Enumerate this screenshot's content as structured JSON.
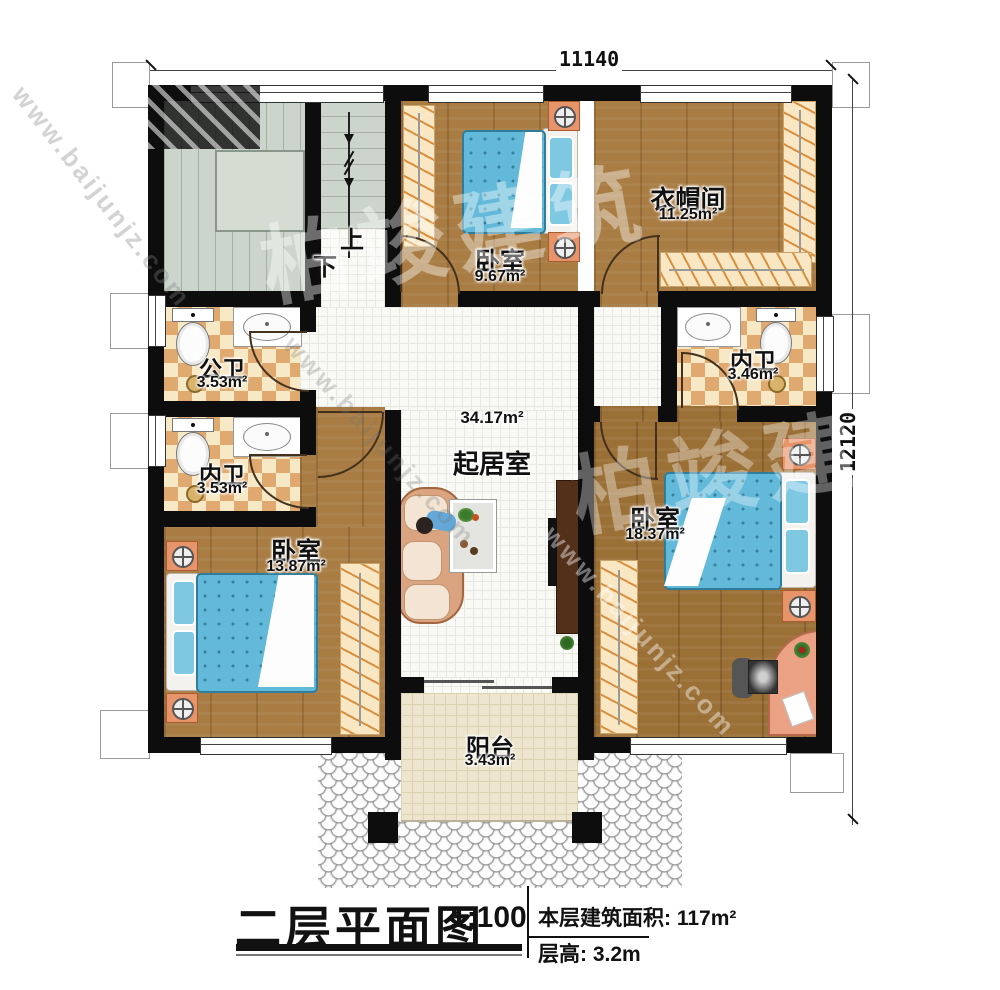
{
  "plan": {
    "dimension_width": "11140",
    "dimension_height": "12120",
    "stair_up": "上",
    "stair_down": "下",
    "rooms": {
      "bedroom_top": {
        "name": "卧室",
        "area": "9.67m²"
      },
      "cloakroom": {
        "name": "衣帽间",
        "area": "11.25m²"
      },
      "public_bath": {
        "name": "公卫",
        "area": "3.53m²"
      },
      "inner_bath_left": {
        "name": "内卫",
        "area": "3.53m²"
      },
      "inner_bath_right": {
        "name": "内卫",
        "area": "3.46m²"
      },
      "living_room": {
        "name": "起居室",
        "area": "34.17m²"
      },
      "bedroom_left": {
        "name": "卧室",
        "area": "13.87m²"
      },
      "bedroom_right": {
        "name": "卧室",
        "area": "18.37m²"
      },
      "balcony": {
        "name": "阳台",
        "area": "3.43m²"
      }
    }
  },
  "title_block": {
    "title": "二层平面图",
    "scale": "1:100",
    "floor_area": "本层建筑面积: 117m²",
    "floor_height": "层高: 3.2m"
  },
  "watermark": {
    "site": "www.baijunjz.com",
    "brand": "柏竣建筑"
  }
}
